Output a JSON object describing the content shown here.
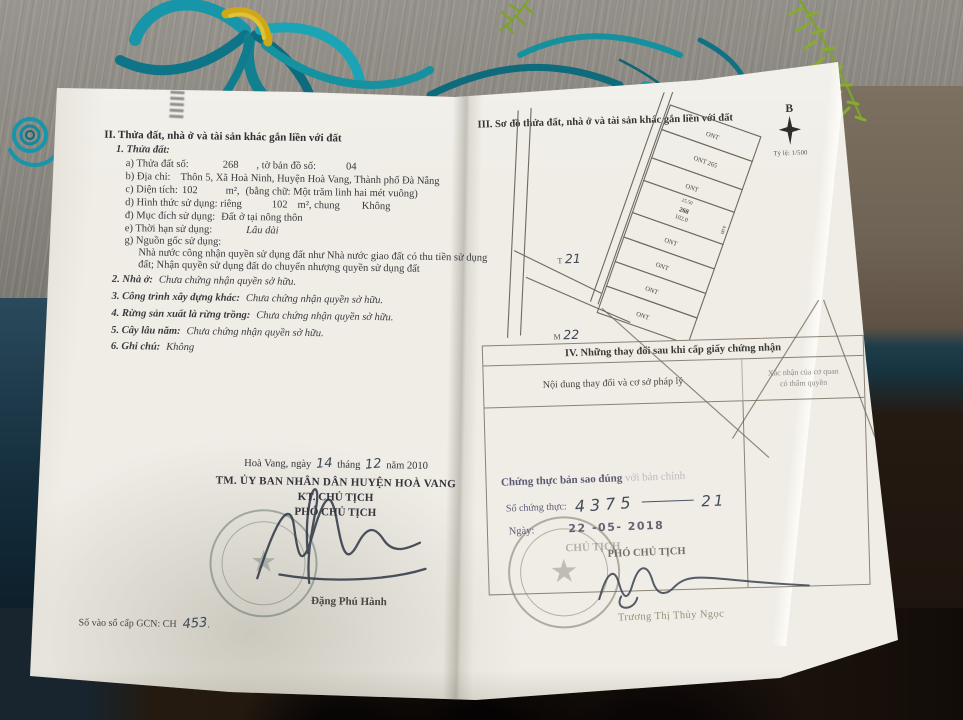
{
  "colors": {
    "paper": "#efede6",
    "embroidery_teal": "#1795a9",
    "embroidery_yellow": "#cfa816",
    "fern_green": "#7da32b",
    "stamp_grey_teal": "#50645f",
    "stamp_grey": "#7d7362",
    "certify_purple": "#5c5a74",
    "ink": "#3a3a3e"
  },
  "left_page": {
    "section_title": "II. Thửa đất, nhà ở và tài sản khác gắn liền với đất",
    "parcel_heading": "1. Thửa đất:",
    "fields": {
      "a_label": "a) Thửa đất số:",
      "a_value": "268",
      "a_label2": ", tờ bản đồ số:",
      "a_value2": "04",
      "b_label": "b) Địa chỉ:",
      "b_value": "Thôn 5, Xã Hoà Ninh, Huyện Hoà Vang, Thành phố Đà Nẵng",
      "c_label": "c) Diện tích:",
      "c_value": "102",
      "c_unit": "m²,",
      "c_words": "(bằng chữ: Một trăm linh hai mét vuông)",
      "d_label": "d) Hình thức sử dụng: riêng",
      "d_value": "102",
      "d_mid": "m², chung",
      "d_value2": "Không",
      "dd_label": "đ) Mục đích sử dụng:",
      "dd_value": "Đất ở tại nông thôn",
      "e_label": "e) Thời hạn sử dụng:",
      "e_value": "Lâu dài",
      "g_label": "g) Nguồn gốc sử dụng:",
      "g_line1": "Nhà nước công nhận quyền sử dụng đất như Nhà nước giao đất có thu tiền sử dụng",
      "g_line2": "đất; Nhận quyền sử dụng đất do chuyển nhượng quyền sử dụng đất"
    },
    "items": {
      "i2_label": "2. Nhà ở:",
      "i2_value": "Chưa chứng nhận quyền sở hữu.",
      "i3_label": "3. Công trình xây dựng khác:",
      "i3_value": "Chưa chứng nhận quyền sở hữu.",
      "i4_label": "4. Rừng sản xuất là rừng trồng:",
      "i4_value": "Chưa chứng nhận quyền sở hữu.",
      "i5_label": "5. Cây lâu năm:",
      "i5_value": "Chưa chứng nhận quyền sở hữu.",
      "i6_label": "6. Ghi chú:",
      "i6_value": "Không"
    },
    "signing": {
      "date_prefix": "Hoà Vang, ngày",
      "date_day": "14",
      "date_mid": "tháng",
      "date_month": "12",
      "date_suffix": "năm 2010",
      "authority": "TM. ỦY BAN NHÂN DÂN HUYỆN HOÀ VANG",
      "title1": "KT. CHỦ TỊCH",
      "title2": "PHÓ CHỦ TỊCH",
      "signer": "Đặng Phú Hành"
    },
    "book_number_label": "Số vào sổ cấp GCN: CH",
    "book_number_value": "453"
  },
  "right_page": {
    "section_title": "III. Sơ đồ thửa đất, nhà ở và tài sản khác gắn liền với đất",
    "compass_letter": "B",
    "map_scale": "Tỷ lệ: 1/500",
    "map": {
      "parcels": [
        "ONT",
        "ONT 265",
        "ONT",
        "268",
        "ONT",
        "ONT",
        "ONT",
        "ONT"
      ],
      "parcel_area": "102.0",
      "dim_top": "25.50",
      "dim_side": "4.00",
      "mark1_prefix": "T",
      "mark1_number": "21",
      "mark2_prefix": "M",
      "mark2_number": "22"
    },
    "changes_table": {
      "title": "IV. Những thay đổi sau khi cấp giấy chứng nhận",
      "col1_header": "Nội dung thay đổi và cơ sở pháp lý",
      "col2_header_line1": "Xác nhận của cơ quan",
      "col2_header_line2": "có thẩm quyền"
    },
    "certification": {
      "line1": "Chứng thực bản sao đúng",
      "line1_faint": "với bản chính",
      "number_label": "Số chứng thực:",
      "number_value": "4375",
      "book_value": "21",
      "date_label": "Ngày:",
      "date_value": "22 -05- 2018",
      "title_faint": "CHỦ TỊCH",
      "title_main": "PHÓ CHỦ TỊCH",
      "signer": "Trương Thị Thủy Ngọc"
    }
  }
}
